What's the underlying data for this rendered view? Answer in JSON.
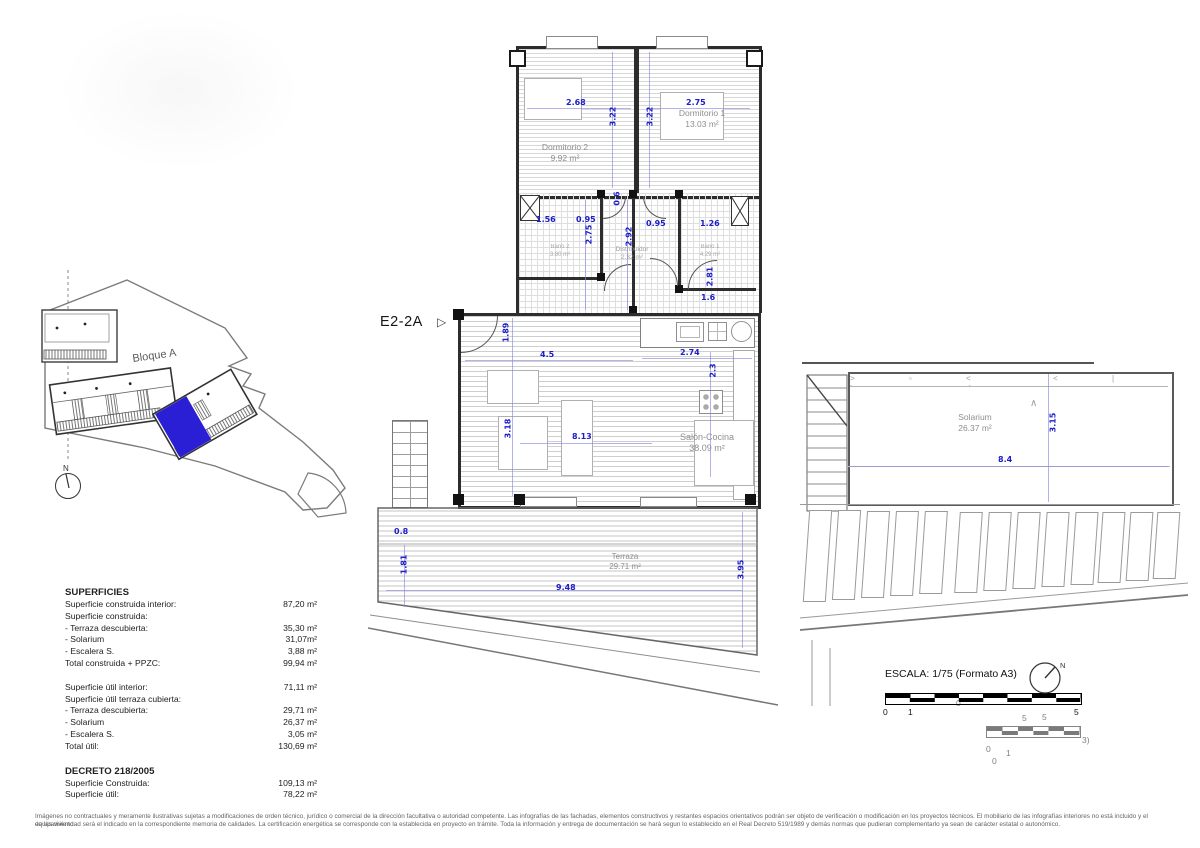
{
  "unit": {
    "label": "E2-2A",
    "pointer_icon": "▷"
  },
  "site_plan": {
    "block_label": "Bloque A",
    "north_label": "N"
  },
  "floor_plan": {
    "rooms": {
      "dorm2": {
        "name": "Dormitorio 2",
        "area": "9.92 m²"
      },
      "dorm1": {
        "name": "Dormitorio 1",
        "area": "13.03 m²"
      },
      "bath2": {
        "name": "Baño 2",
        "area": "3.80 m²"
      },
      "hall": {
        "name": "Distribuidor",
        "area": "2.32 m²"
      },
      "bath1": {
        "name": "Baño 1",
        "area": "4.29 m²"
      },
      "salon": {
        "name": "Salón-Cocina",
        "area": "38.09 m²"
      },
      "terrace": {
        "name": "Terraza",
        "area": "29.71 m²"
      }
    },
    "dims": [
      "2.68",
      "3.22",
      "3.22",
      "2.75",
      "1.56",
      "0.95",
      "0.6",
      "2.75",
      "2.92",
      "0.95",
      "1.26",
      "2.81",
      "1.6",
      "1.89",
      "4.5",
      "2.74",
      "2.3",
      "3.18",
      "8.13",
      "0.8",
      "1.81",
      "9.48",
      "3.95"
    ],
    "dim_color": "#1c1cc9",
    "highlight_color": "#2a1fd4"
  },
  "solarium_plan": {
    "room": {
      "name": "Solarium",
      "area": "26.37 m²"
    },
    "dims": [
      "8.4",
      "3.15"
    ],
    "slope_mark": "∧"
  },
  "surfaces": {
    "title": "SUPERFICIES",
    "group1": [
      {
        "label": "Superficie construida interior:",
        "value": "87,20 m²"
      },
      {
        "label": "Superficie construida:",
        "value": ""
      },
      {
        "label": "- Terraza descubierta:",
        "value": "35,30 m²"
      },
      {
        "label": "- Solarium",
        "value": "31,07m²"
      },
      {
        "label": "- Escalera S.",
        "value": "3,88 m²"
      },
      {
        "label": "Total construida + PPZC:",
        "value": "99,94 m²"
      }
    ],
    "group2": [
      {
        "label": "Superficie útil interior:",
        "value": "71,11 m²"
      },
      {
        "label": "Superficie útil terraza cubierta:",
        "value": ""
      },
      {
        "label": "- Terraza descubierta:",
        "value": "29,71 m²"
      },
      {
        "label": "- Solarium",
        "value": "26,37 m²"
      },
      {
        "label": "- Escalera S.",
        "value": "3,05 m²"
      },
      {
        "label": "Total útil:",
        "value": "130,69 m²"
      }
    ],
    "decree_title": "DECRETO 218/2005",
    "group3": [
      {
        "label": "Superficie Construida:",
        "value": "109,13 m²"
      },
      {
        "label": "Superficie útil:",
        "value": "78,22 m²"
      }
    ]
  },
  "scale": {
    "label": "ESCALA: 1/75 (Formato A3)",
    "ticks": [
      "0",
      "1",
      "5"
    ],
    "north_label": "N",
    "ghost": {
      "t0top": "0",
      "t5a": "5",
      "t5b": "5",
      "t0a": "0",
      "t1": "1",
      "t0b": "0",
      "t3": "3)"
    }
  },
  "disclaimer": {
    "line1": "Imágenes no contractuales y meramente ilustrativas sujetas a modificaciones de orden técnico, jurídico o comercial de la dirección facultativa o autoridad competente.  Las infografías de las fachadas, elementos constructivos y restantes espacios orientativos podrán ser objeto de verificación o modificación en los proyectos técnicos.  El mobiliario de las infografías interiores no está incluido y el equipamiento",
    "line2": "de las viviendad será el indicado en la correspondiente memoria de calidades.  La certificación energética se corresponde con la establecida en proyecto en trámite.  Toda la información y entrega de documentación se hará segun lo establecido en el Real Decreto 519/1989  y demás normas que pudieran complementarlo ya sean de carácter estatal o autonómico."
  }
}
